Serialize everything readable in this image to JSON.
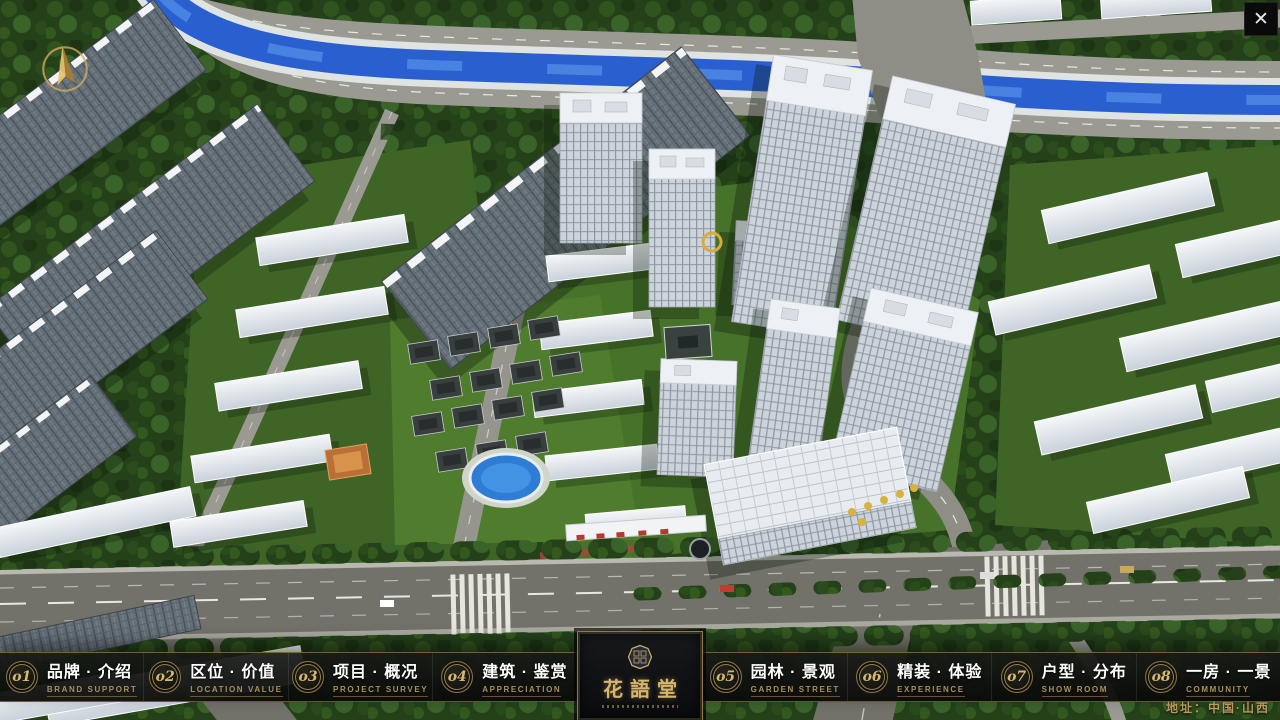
{
  "window": {
    "close_label": "✕"
  },
  "nav": {
    "items": [
      {
        "num": "o1",
        "zh": "品牌 · 介绍",
        "en": "BRAND SUPPORT"
      },
      {
        "num": "o2",
        "zh": "区位 · 价值",
        "en": "LOCATION VALUE"
      },
      {
        "num": "o3",
        "zh": "项目 · 概况",
        "en": "PROJECT SURVEY"
      },
      {
        "num": "o4",
        "zh": "建筑 · 鉴赏",
        "en": "APPRECIATION"
      },
      {
        "num": "o5",
        "zh": "园林 · 景观",
        "en": "GARDEN STREET"
      },
      {
        "num": "o6",
        "zh": "精装 · 体验",
        "en": "EXPERIENCE"
      },
      {
        "num": "o7",
        "zh": "户型 · 分布",
        "en": "SHOW ROOM"
      },
      {
        "num": "o8",
        "zh": "一房 · 一景",
        "en": "COMMUNITY"
      }
    ]
  },
  "logo": {
    "title": "花語堂"
  },
  "footer": {
    "address": "地址：中国·山西"
  },
  "colors": {
    "accent_gold": "#c8a85e",
    "nav_background": "#0f110f",
    "text_white": "#ffffff",
    "river_blue": "#2a5fd0",
    "tree_green": "#24411a"
  }
}
